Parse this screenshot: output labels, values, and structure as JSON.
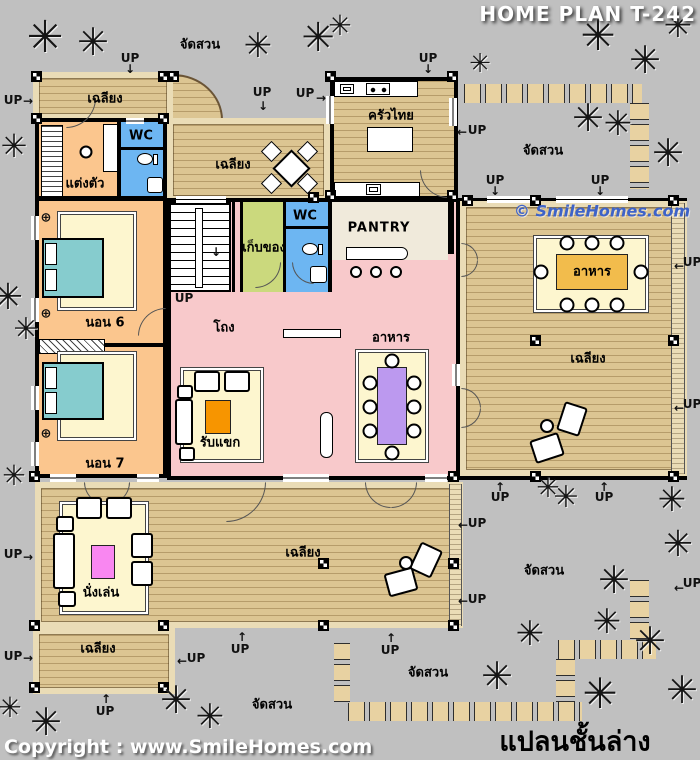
{
  "title": "HOME PLAN T-242",
  "watermark": "© SmileHomes.com",
  "footer": {
    "copyright": "Copyright : www.SmileHomes.com",
    "caption": "แปลนชั้นล่าง"
  },
  "labels": {
    "up": "UP",
    "garden": "จัดสวน",
    "porch": "เฉลียง",
    "wc": "WC",
    "dressing": "แต่งตัว",
    "thai_kitchen": "ครัวไทย",
    "pantry": "PANTRY",
    "storage": "เก็บของ",
    "bedroom6": "นอน 6",
    "bedroom7": "นอน 7",
    "hall": "โถง",
    "living": "รับแขก",
    "dining": "อาหาร",
    "sitting": "นั่งเล่น"
  },
  "icons": {
    "tree": "✳",
    "arrow_up": "↑",
    "arrow_down": "↓",
    "arrow_left": "←",
    "arrow_right": "→",
    "fan": "⊕",
    "stair_arrow": "↓"
  },
  "colors": {
    "background": "#C0C0C0",
    "deck_wood": "#DCC592",
    "deck_edge": "#EADCB6",
    "bedroom_peach": "#FBC68E",
    "hall_pink": "#F8C9CB",
    "wc_blue": "#6DB6F2",
    "storage_green": "#CBD97D",
    "pantry_cream": "#F0EADB",
    "furniture_mat": "#FDF6CF",
    "bed_teal": "#86CCCE",
    "living_table_orange": "#F79500",
    "outdoor_dining_table": "#F2BC4C",
    "indoor_dining_table": "#BC99EF",
    "sitting_table_pink": "#F987F1",
    "watermark_blue": "#3E63C8",
    "title_white": "#FFFFFF"
  }
}
